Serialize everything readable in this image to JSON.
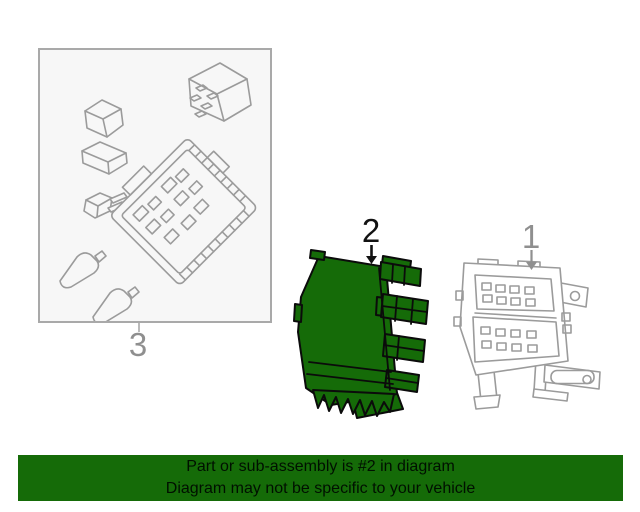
{
  "diagram": {
    "callouts": {
      "part1": "1",
      "part2": "2",
      "part3": "3"
    },
    "highlighted_callout": "2",
    "parts": [
      {
        "callout": "1",
        "drawing": "fuse-block-outline",
        "highlighted": false
      },
      {
        "callout": "2",
        "drawing": "body-control-module",
        "highlighted": true
      },
      {
        "callout": "3",
        "drawing": "fuse-box-component-kit-in-box",
        "highlighted": false
      }
    ]
  },
  "banner": {
    "line1": "Part or sub-assembly is #2 in diagram",
    "line2": "Diagram may not be specific to your vehicle"
  },
  "colors": {
    "highlight_green": "#156b08",
    "banner_green": "#156b08",
    "banner_text": "#001000",
    "outline_gray": "#9b9b9b",
    "callout_gray": "#8f8f8f",
    "callout_black": "#121212",
    "box_border_gray": "#a9a9a9",
    "box_background": "#f7f7f7"
  }
}
